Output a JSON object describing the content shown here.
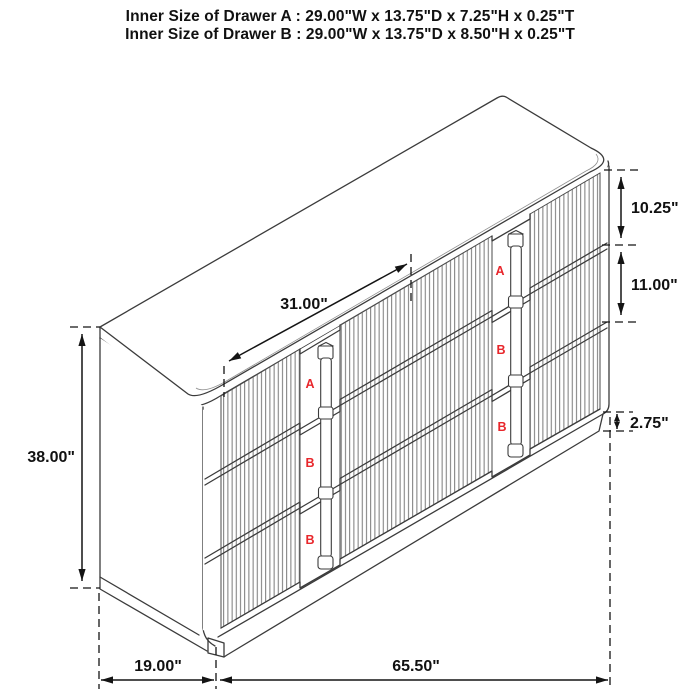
{
  "header": {
    "line1": "Inner Size of Drawer A : 29.00\"W x 13.75\"D x 7.25\"H x 0.25\"T",
    "line2": "Inner Size of Drawer B : 29.00\"W x 13.75\"D x 8.50\"H x 0.25\"T"
  },
  "dimensions": {
    "overall_height": "38.00\"",
    "overall_depth": "19.00\"",
    "overall_width": "65.50\"",
    "top_clear_width": "31.00\"",
    "top_drawer_height": "10.25\"",
    "middle_drawer_height": "11.00\"",
    "base_height": "2.75\""
  },
  "drawer_stacks": {
    "left": [
      "A",
      "B",
      "B"
    ],
    "right": [
      "A",
      "B",
      "B"
    ]
  },
  "colors": {
    "line": "#3b3b3b",
    "flute_line": "#6a6a6a",
    "dimension": "#141414",
    "label_red": "#e8262b",
    "background": "#ffffff"
  }
}
